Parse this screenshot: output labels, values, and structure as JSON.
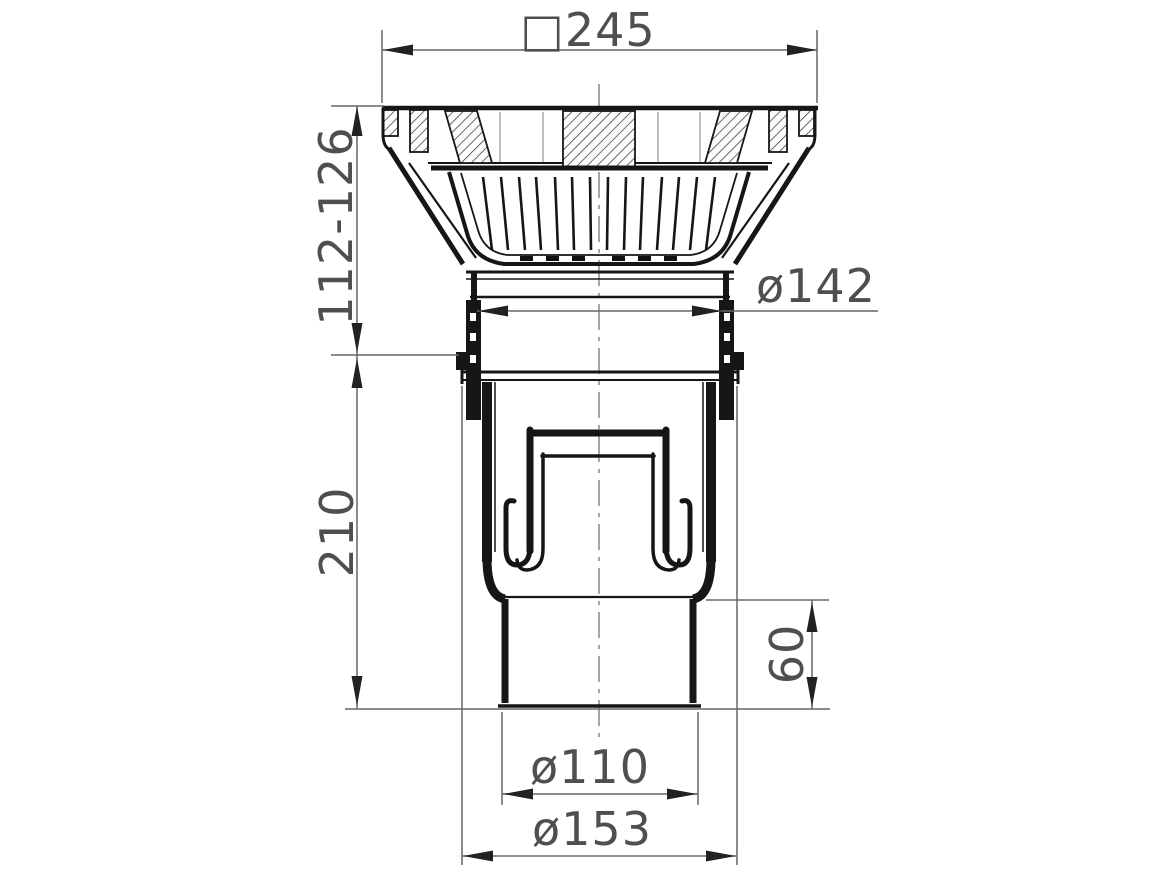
{
  "diagram": {
    "kind": "technical-drawing",
    "subject": "drain gully cross-section",
    "colors": {
      "body_line": "#161616",
      "dimension_line": "#666666",
      "label_text": "#4f4f4f",
      "background": "#ffffff",
      "hatch": "#2e2e2e"
    },
    "dimensions": [
      {
        "id": "top-flange-square-width",
        "label": "□245",
        "orientation": "horizontal"
      },
      {
        "id": "adjustable-height",
        "label": "112-126",
        "orientation": "vertical"
      },
      {
        "id": "neck-diameter",
        "label": "ø142",
        "orientation": "horizontal"
      },
      {
        "id": "body-height",
        "label": "210",
        "orientation": "vertical"
      },
      {
        "id": "outlet-spigot-length",
        "label": "60",
        "orientation": "vertical"
      },
      {
        "id": "outlet-pipe-diameter",
        "label": "ø110",
        "orientation": "horizontal"
      },
      {
        "id": "flange-diameter",
        "label": "ø153",
        "orientation": "horizontal"
      }
    ]
  }
}
